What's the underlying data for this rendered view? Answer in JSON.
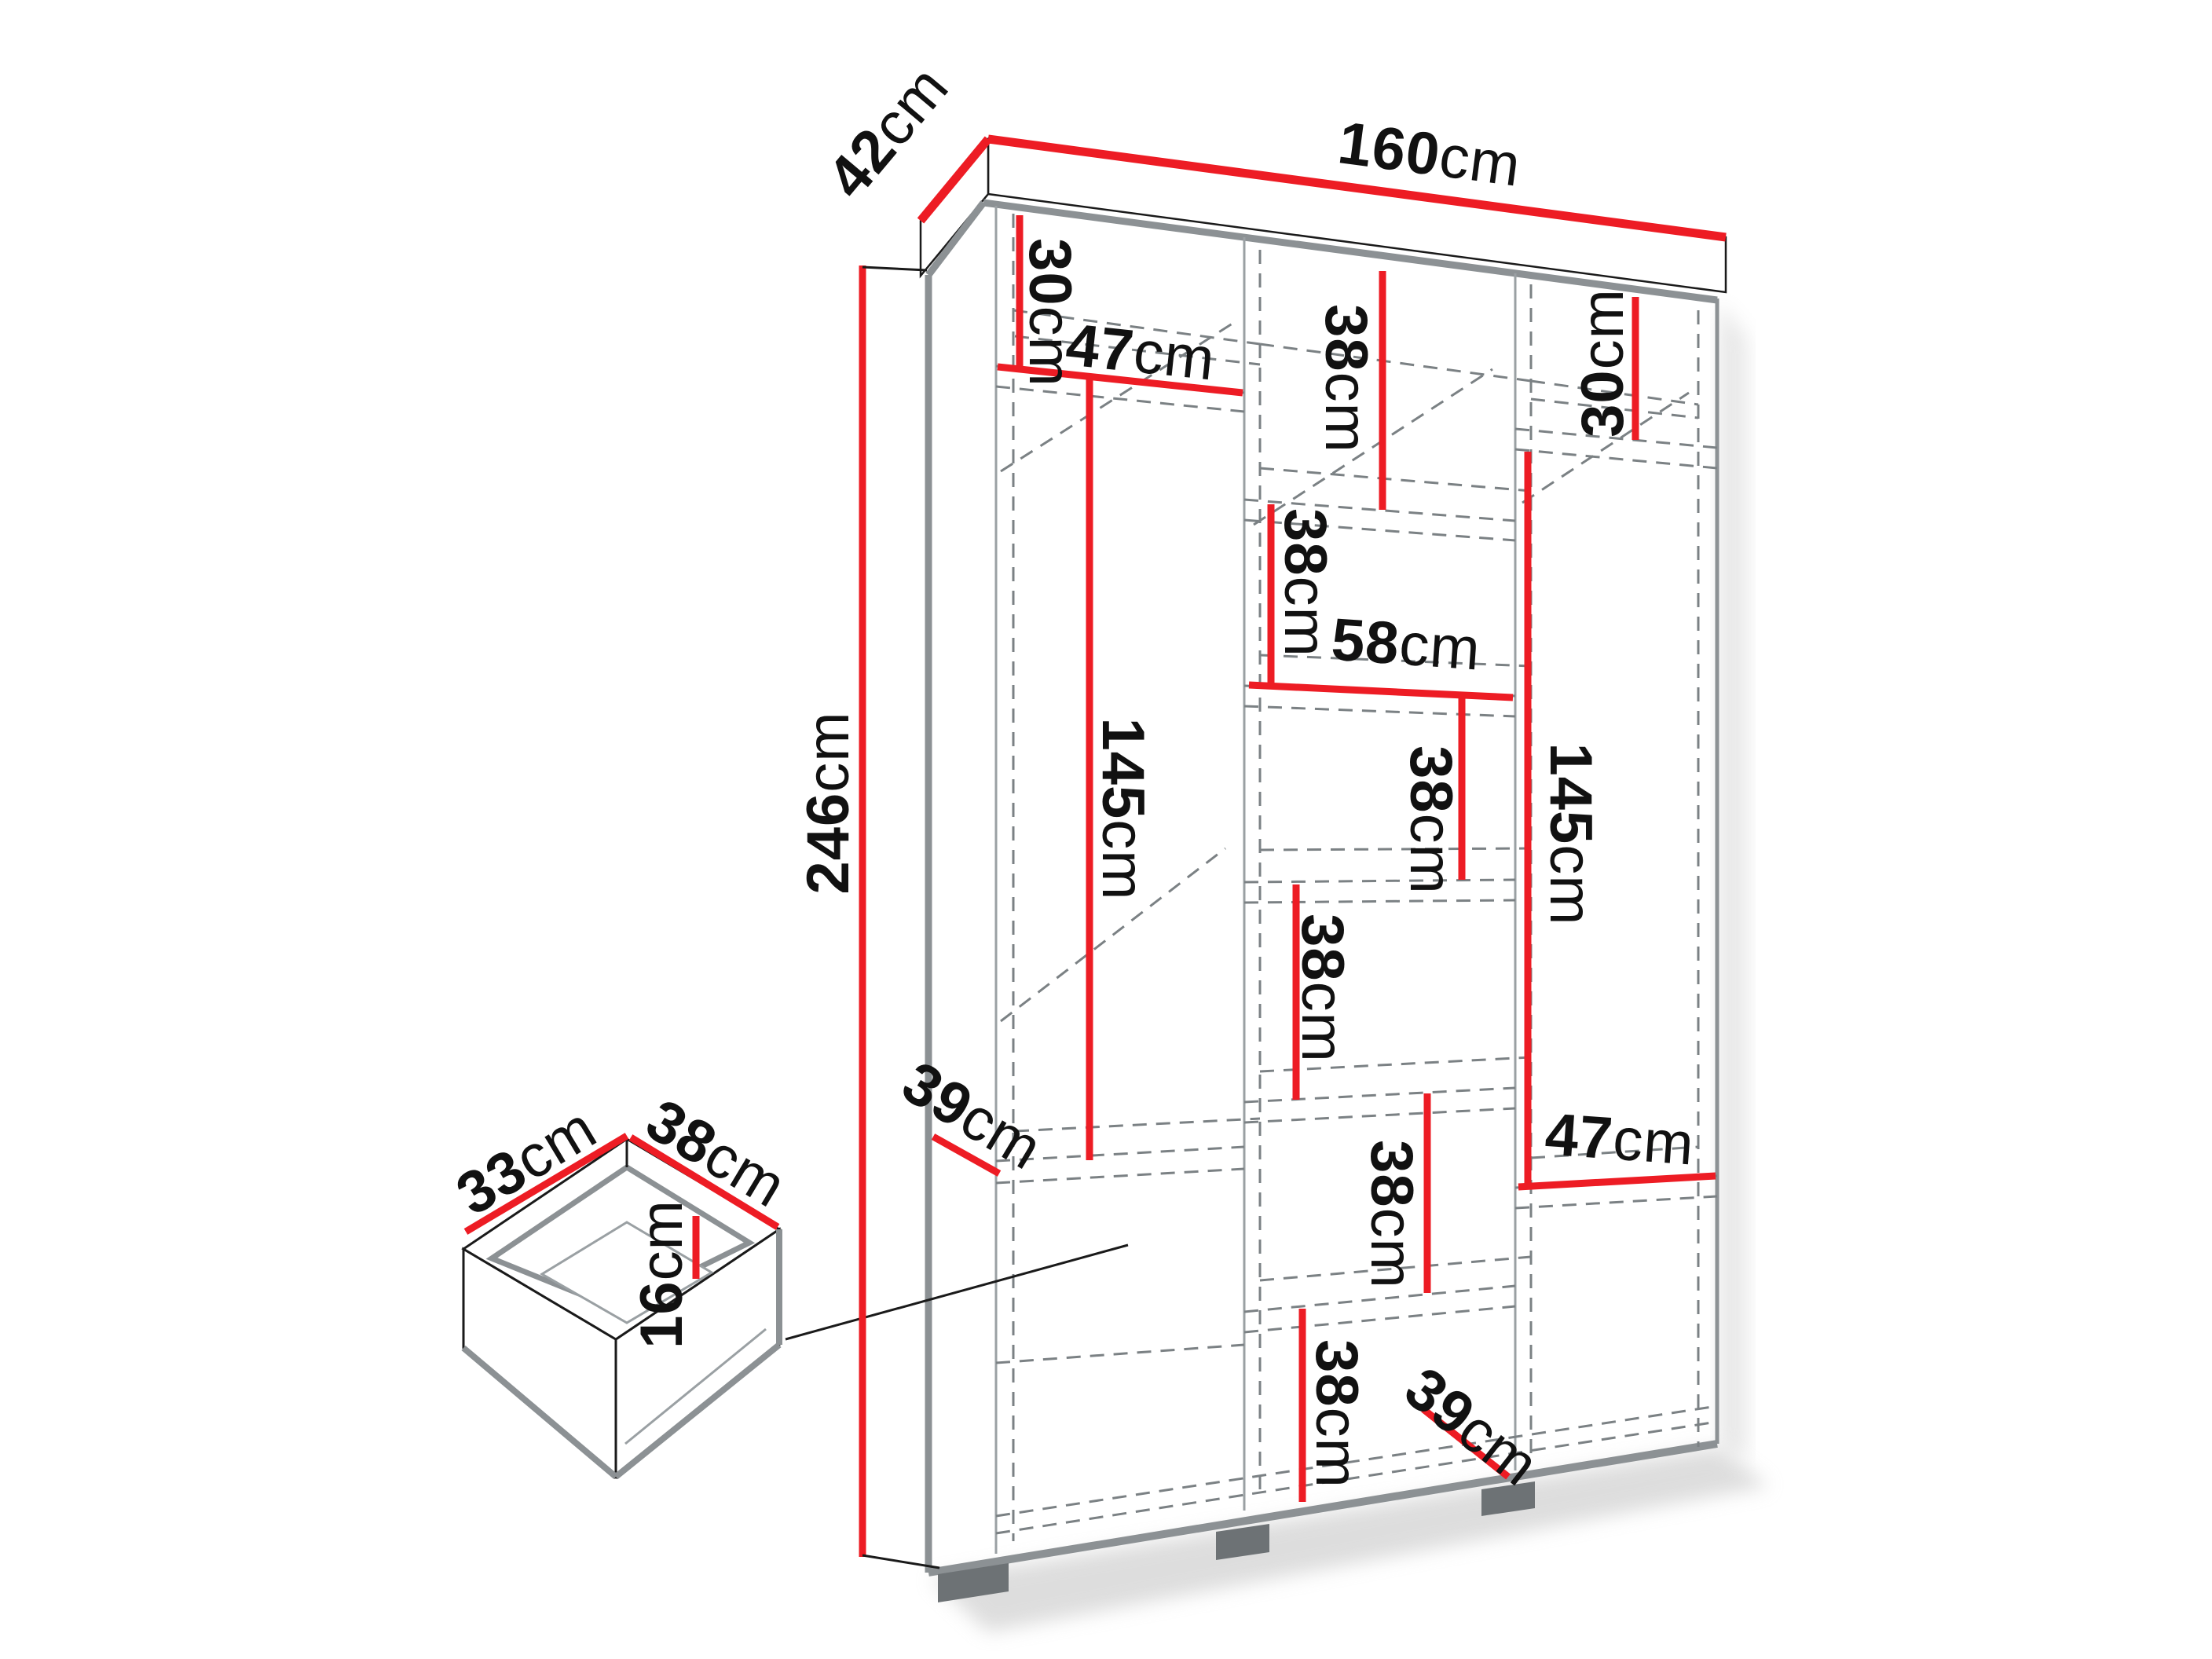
{
  "diagram": {
    "type": "furniture dimension drawing",
    "subject": "three-section wardrobe shown in perspective with dashed interior shelving, plus an exploded drawer detail",
    "colors": {
      "dimension_red": "#ed1c24",
      "outline_black": "#1a1a1a",
      "panel_gray": "#8c9194",
      "dashed_gray": "#7b8184",
      "feet_gray": "#6d7275",
      "background": "#ffffff"
    },
    "overall": {
      "width": {
        "num": "160",
        "unit": "cm"
      },
      "depth": {
        "num": "42",
        "unit": "cm"
      },
      "height": {
        "num": "246",
        "unit": "cm"
      }
    },
    "drawer_detail": {
      "width": {
        "num": "38",
        "unit": "cm"
      },
      "depth": {
        "num": "33",
        "unit": "cm"
      },
      "inner_height": {
        "num": "16",
        "unit": "cm"
      }
    },
    "labels": {
      "d160": {
        "num": "160",
        "unit": "cm"
      },
      "d42": {
        "num": "42",
        "unit": "cm"
      },
      "d246": {
        "num": "246",
        "unit": "cm"
      },
      "d30l": {
        "num": "30",
        "unit": "cm"
      },
      "d47l": {
        "num": "47",
        "unit": "cm"
      },
      "d145l": {
        "num": "145",
        "unit": "cm"
      },
      "d39l": {
        "num": "39",
        "unit": "cm"
      },
      "d38m1": {
        "num": "38",
        "unit": "cm"
      },
      "d38m2": {
        "num": "38",
        "unit": "cm"
      },
      "d58": {
        "num": "58",
        "unit": "cm"
      },
      "d38m3": {
        "num": "38",
        "unit": "cm"
      },
      "d38m4": {
        "num": "38",
        "unit": "cm"
      },
      "d38m5": {
        "num": "38",
        "unit": "cm"
      },
      "d38m6": {
        "num": "38",
        "unit": "cm"
      },
      "d30r": {
        "num": "30",
        "unit": "cm"
      },
      "d145r": {
        "num": "145",
        "unit": "cm"
      },
      "d47r": {
        "num": "47",
        "unit": "cm"
      },
      "d39r": {
        "num": "39",
        "unit": "cm"
      },
      "d33dr": {
        "num": "33",
        "unit": "cm"
      },
      "d38dr": {
        "num": "38",
        "unit": "cm"
      },
      "d16dr": {
        "num": "16",
        "unit": "cm"
      }
    }
  }
}
